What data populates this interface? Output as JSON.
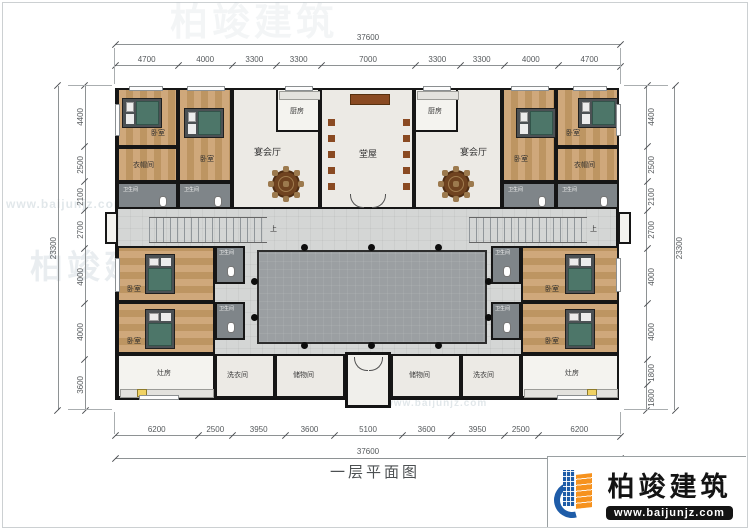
{
  "page": {
    "title": "一层平面图"
  },
  "brand": {
    "name": "柏竣建筑",
    "url": "www.baijunjz.com"
  },
  "watermark": {
    "name": "柏竣建筑",
    "url": "www.baijunjz.com"
  },
  "dimensions": {
    "top": {
      "total": "37600",
      "segments": [
        "4700",
        "4000",
        "3300",
        "3300",
        "7000",
        "3300",
        "3300",
        "4000",
        "4700"
      ]
    },
    "bottom": {
      "total": "37600",
      "segments": [
        "6200",
        "2500",
        "3950",
        "3600",
        "5100",
        "3600",
        "3950",
        "2500",
        "6200"
      ]
    },
    "left": {
      "total": "23300",
      "segments": [
        "4400",
        "2500",
        "2100",
        "2700",
        "4000",
        "4000",
        "3600"
      ]
    },
    "right": {
      "total": "23300",
      "segments": [
        "4400",
        "2500",
        "2100",
        "2700",
        "4000",
        "4000",
        "1800",
        "1800"
      ]
    }
  },
  "rooms": {
    "bedroom": "卧室",
    "banquet_hall": "宴会厅",
    "kitchen": "厨房",
    "main_hall": "堂屋",
    "cloakroom": "衣帽间",
    "bathroom": "卫生间",
    "laundry": "洗衣间",
    "storage": "储物间",
    "stove_room": "灶房",
    "stairs_up": "上"
  },
  "colors": {
    "wall": "#141414",
    "wood_floor": "#c9a06c",
    "courtyard": "#9b9fa2",
    "walkway": "#d4d6d5",
    "logo_blue": "#1e5ca8",
    "logo_orange": "#f6921e"
  }
}
